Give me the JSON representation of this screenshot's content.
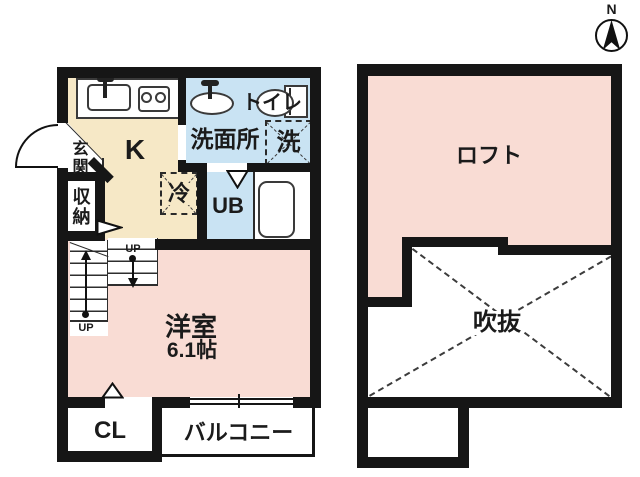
{
  "palette": {
    "wall": "#161616",
    "kitchen_fill": "#f6e8c6",
    "wet_area_fill": "#c9e3f3",
    "room_fill": "#f9dcd4",
    "paper": "#ffffff",
    "line": "#333333"
  },
  "compass": {
    "north_label": "N"
  },
  "floor_plan_left": {
    "rooms": {
      "entrance": {
        "label": "玄関"
      },
      "kitchen": {
        "label": "K"
      },
      "storage": {
        "label": "収納"
      },
      "washroom": {
        "label": "洗面所"
      },
      "toilet": {
        "label": "トイレ"
      },
      "washer": {
        "label": "洗"
      },
      "fridge": {
        "label": "冷"
      },
      "unit_bath": {
        "label": "UB"
      },
      "western_room": {
        "label": "洋室",
        "size": "6.1帖"
      },
      "closet": {
        "label": "CL"
      },
      "balcony": {
        "label": "バルコニー"
      }
    },
    "stairs": {
      "up_lower": "UP",
      "up_upper": "UP"
    }
  },
  "floor_plan_right": {
    "rooms": {
      "loft": {
        "label": "ロフト"
      },
      "void": {
        "label": "吹抜"
      }
    }
  },
  "icons": {
    "kitchen_sink": "sink-icon",
    "stove": "stove-icon",
    "washbasin": "washbasin-icon",
    "toilet": "toilet-icon",
    "bathtub": "bathtub-icon",
    "entrance_door": "door-swing-arc-icon",
    "stairs": "stairs-icon",
    "compass": "compass-north-icon"
  }
}
